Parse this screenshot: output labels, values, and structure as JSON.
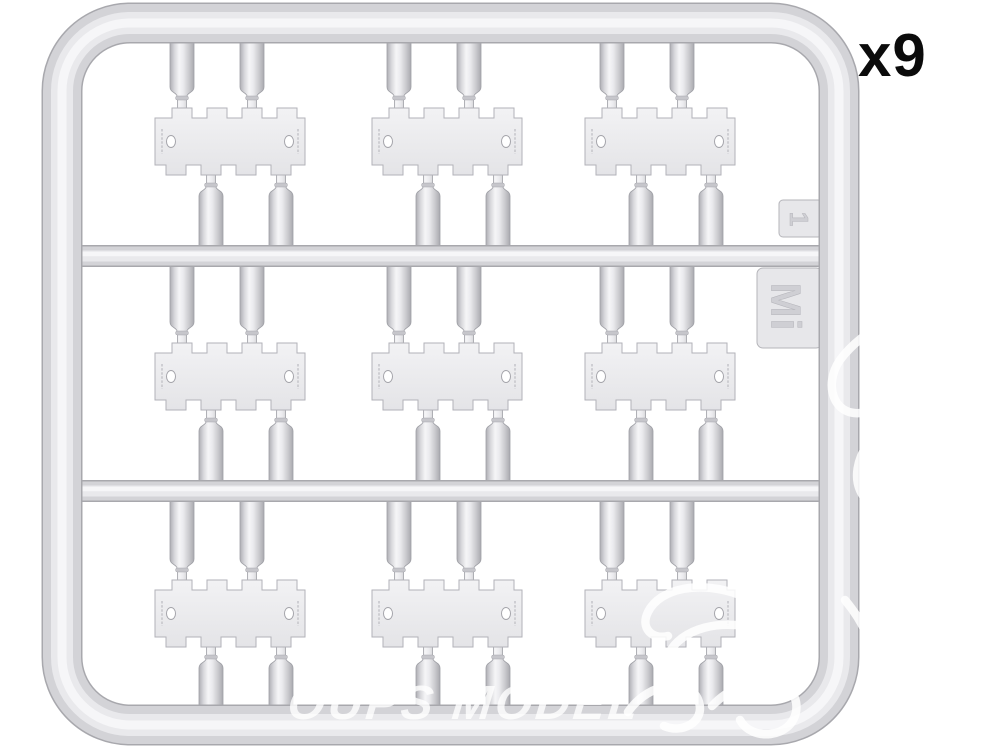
{
  "header": {
    "quantity_label": "x9"
  },
  "sprue": {
    "gate_label": "1",
    "brand_mark": "Mi",
    "rows": 3,
    "columns": 3,
    "cluster_count": 9,
    "parts_per_cluster": {
      "plates": 1,
      "cylinders": 4
    }
  },
  "watermark": {
    "text": "OUPS MODEL"
  },
  "colors": {
    "background": "#ffffff",
    "plastic_base": "#d3d3d7",
    "plastic_highlight": "#f6f6f8",
    "plastic_shadow": "#a8a8ad",
    "plate_fill": "#eeeef0",
    "label_text": "#0b0b0b",
    "watermark_white": "#ffffff"
  }
}
